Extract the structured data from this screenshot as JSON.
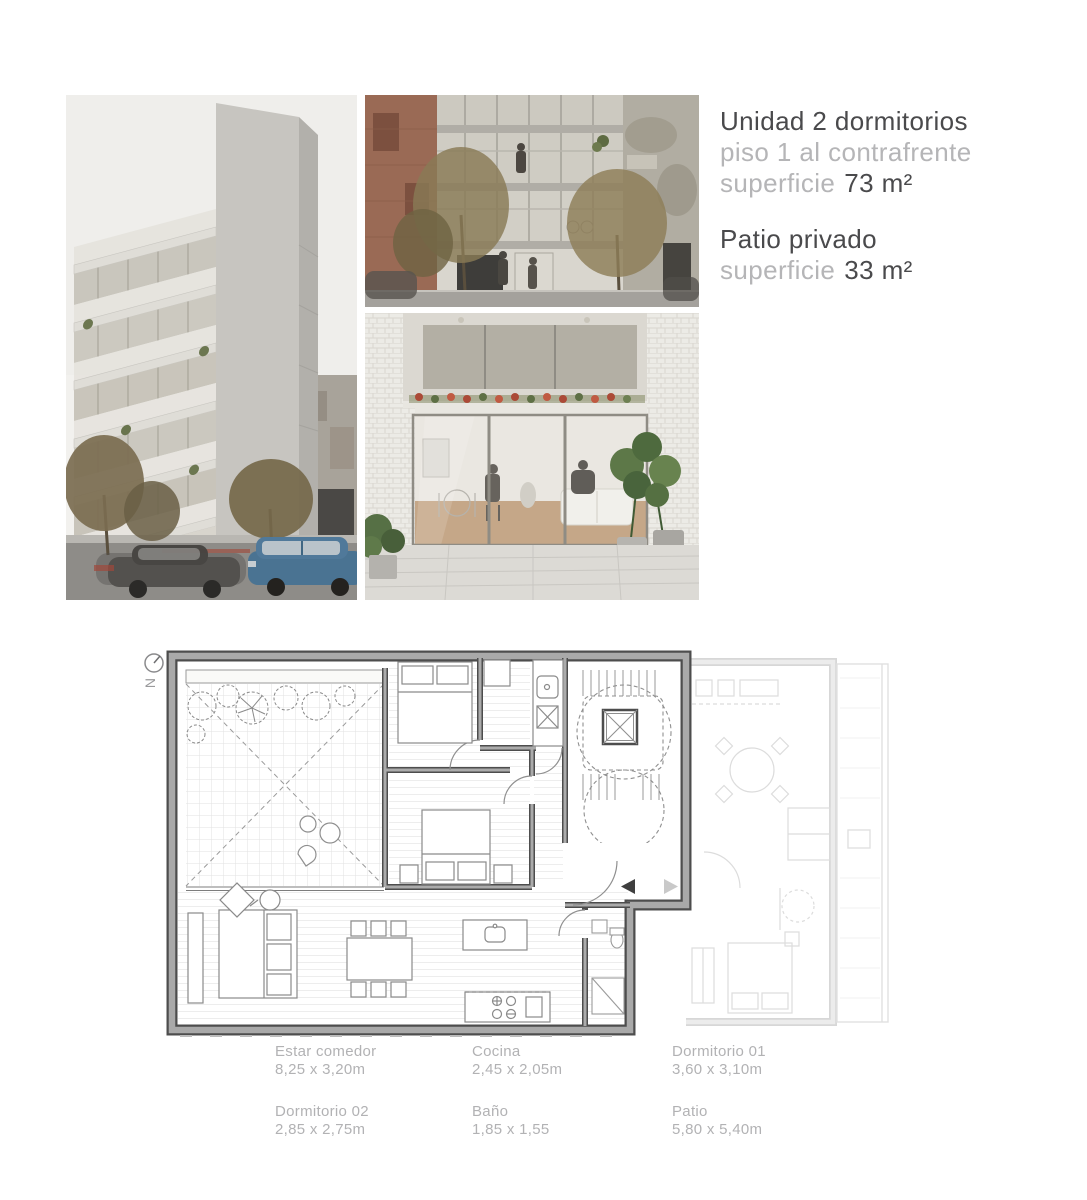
{
  "unit_info": {
    "title": "Unidad 2 dormitorios",
    "subtitle": "piso 1 al contrafrente",
    "area_label": "superficie",
    "area_value": "73 m²",
    "patio": {
      "title": "Patio privado",
      "area_label": "superficie",
      "area_value": "33 m²"
    }
  },
  "floor_plan": {
    "north_label": "N"
  },
  "legend": {
    "columns": [
      {
        "items": [
          {
            "name": "Estar comedor",
            "dims": "8,25 x 3,20m"
          },
          {
            "name": "Dormitorio 02",
            "dims": "2,85 x 2,75m"
          }
        ]
      },
      {
        "items": [
          {
            "name": "Cocina",
            "dims": "2,45 x 2,05m"
          },
          {
            "name": "Baño",
            "dims": "1,85 x 1,55"
          }
        ]
      },
      {
        "items": [
          {
            "name": "Dormitorio 01",
            "dims": "3,60 x 3,10m"
          },
          {
            "name": "Patio",
            "dims": "5,80 x 5,40m"
          }
        ]
      }
    ]
  },
  "photos": {
    "left": "building-exterior-render",
    "top_middle": "street-level-facade-render",
    "bottom_middle": "patio-courtyard-render"
  },
  "colors": {
    "text_dark": "#4a4a4c",
    "text_light": "#b5b5b7",
    "plan_wall_dark": "#4d4d4d",
    "plan_wall_fill": "#a9a9a9",
    "car_blue": "#4a7392",
    "flower_red": "#b04a38"
  }
}
